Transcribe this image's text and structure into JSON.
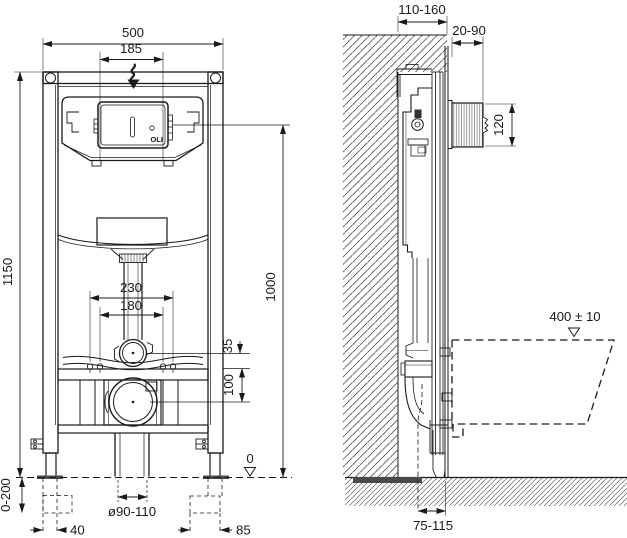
{
  "colors": {
    "line": "#1a1a1a",
    "background": "#ffffff",
    "foot_plate": "#4a4a4a"
  },
  "front_view": {
    "logo": "OLI",
    "dims": {
      "width_overall": "500",
      "flush_plate_width": "185",
      "height_overall": "1150",
      "flush_unit_height": "1000",
      "fixing_bolts_outer": "230",
      "fixing_bolts_inner": "180",
      "flush_bend_offset": "35",
      "rail_to_drain": "100",
      "leg_adjustment": "0-200",
      "foot_width": "40",
      "foot_plate_length": "85",
      "drain_diameter": "ø90-110",
      "floor_level": "0"
    }
  },
  "side_view": {
    "dims": {
      "frame_depth": "110-160",
      "wall_finish_depth": "20-90",
      "access_box_height": "120",
      "bowl_top_height": "400 ± 10",
      "outlet_to_wall": "75-115"
    }
  }
}
